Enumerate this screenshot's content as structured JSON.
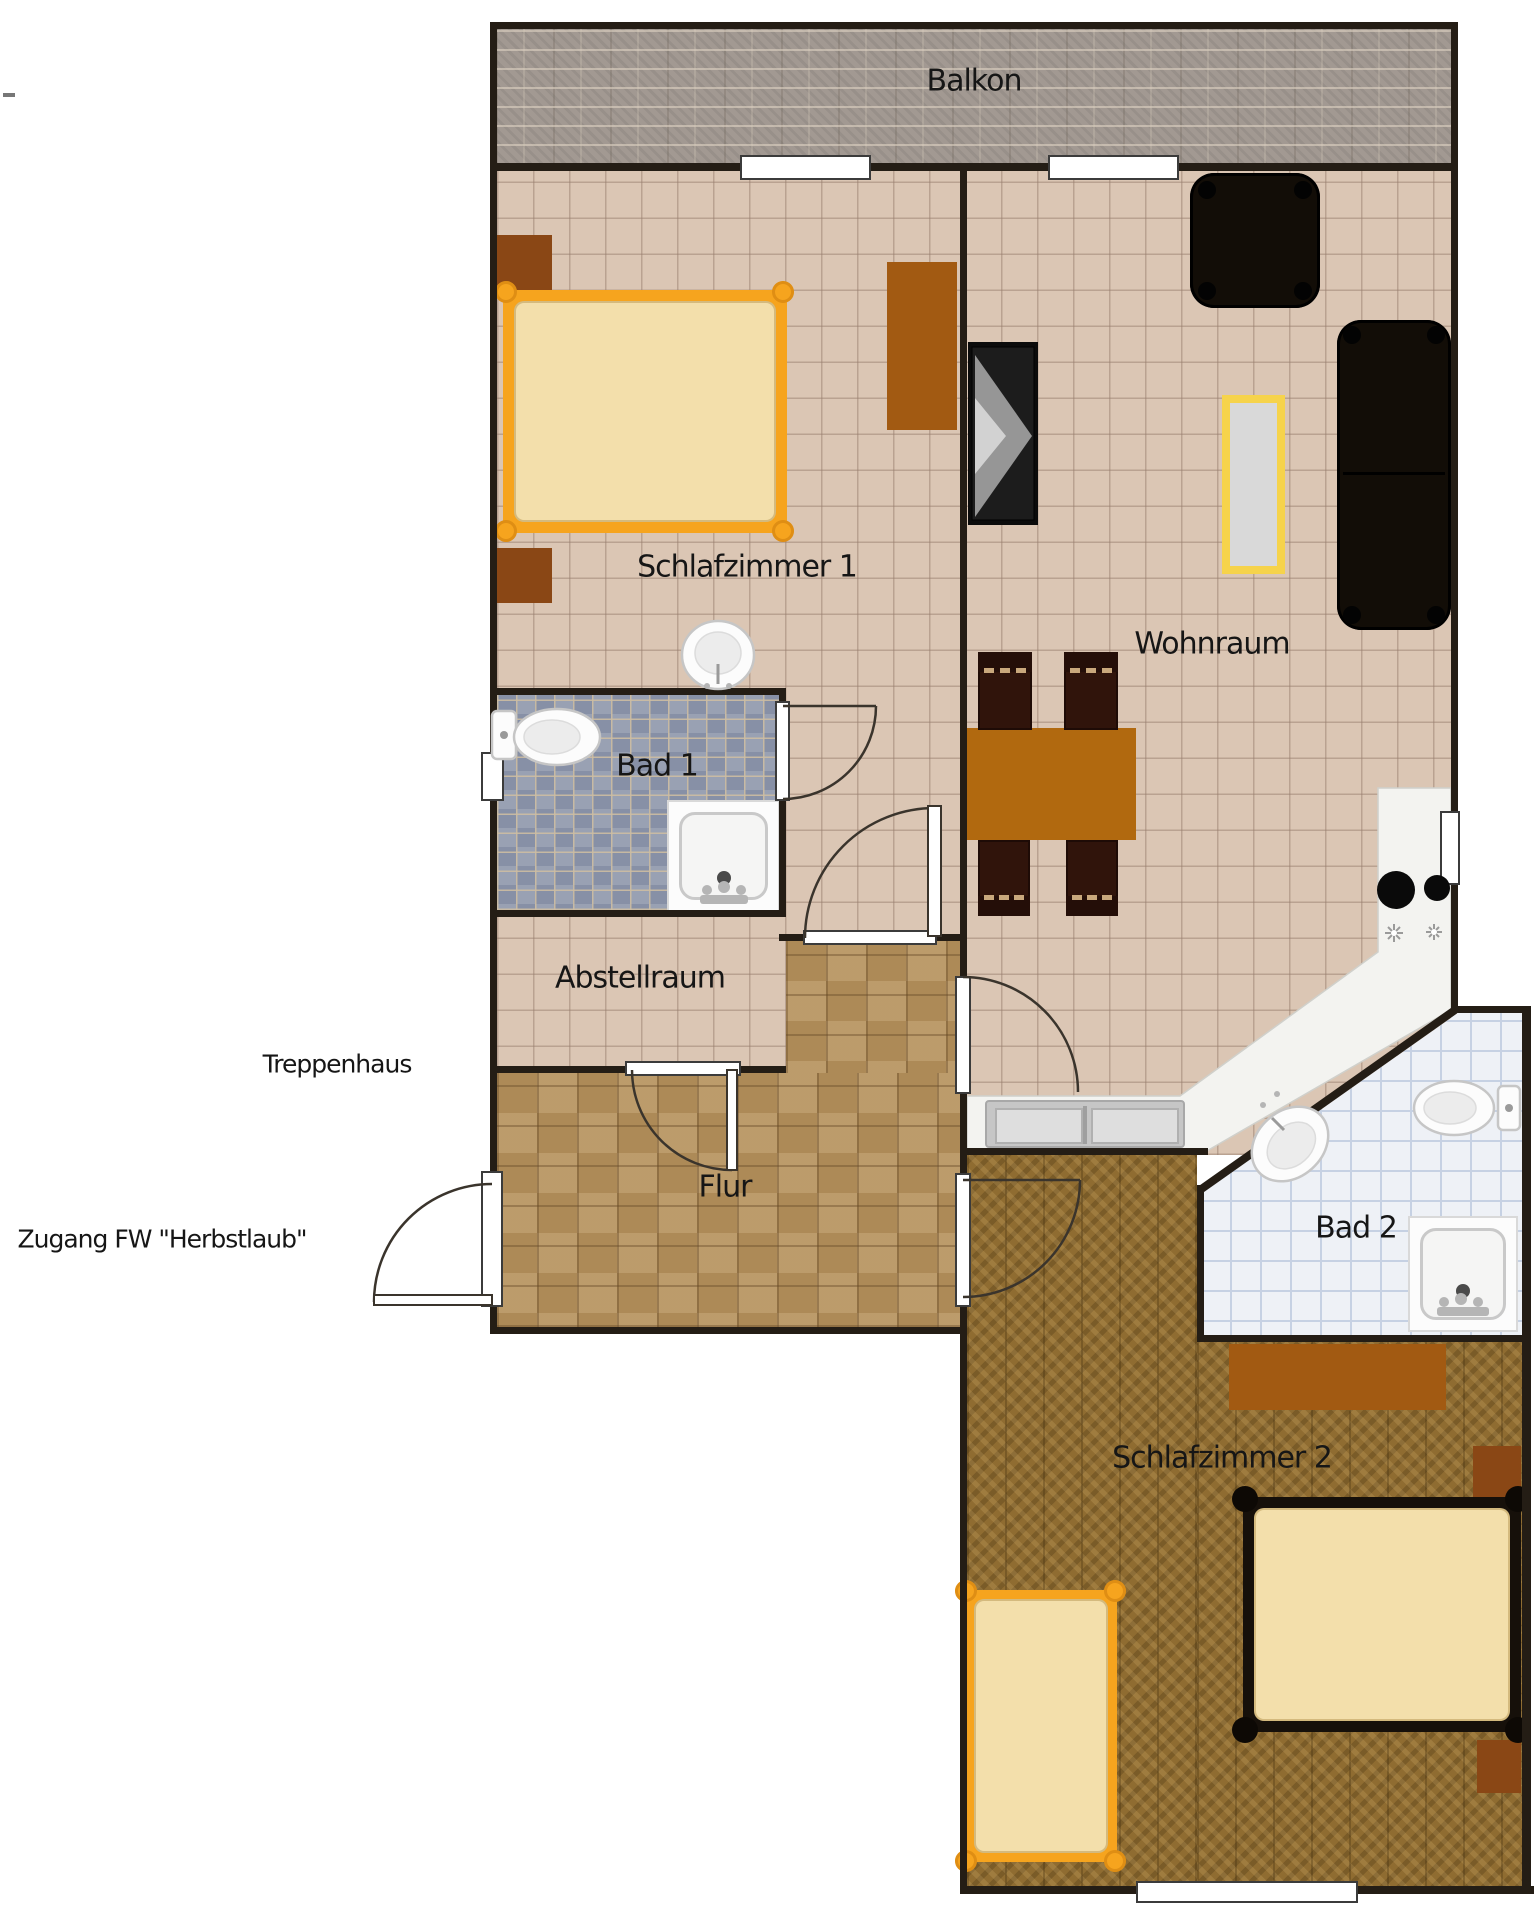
{
  "labels": {
    "balkon": "Balkon",
    "schlafzimmer1": "Schlafzimmer 1",
    "wohnraum": "Wohnraum",
    "bad1": "Bad 1",
    "abstellraum": "Abstellraum",
    "treppenhaus": "Treppenhaus",
    "flur": "Flur",
    "zugang": "Zugang FW \"Herbstlaub\"",
    "bad2": "Bad 2",
    "schlafzimmer2": "Schlafzimmer 2"
  },
  "colors": {
    "wall": "#241d15",
    "door_arc": "#3a342c",
    "opening_border": "#3b3b3b",
    "tile_floor": "#dbc6b4",
    "bad1_tile_a": "#99a1b3",
    "bad1_tile_b": "#8790a6",
    "flur_block": "#ad8a57",
    "parquet": "#8f6c31",
    "bad2_tile": "#eef1f6",
    "bad2_line": "#c6d1e3",
    "balcony_stone": "#a29992",
    "bed_orange": "#f6a41e",
    "bed_dark": "#16100a",
    "mattress": "#f3dfab",
    "wood_dark": "#8a4715",
    "wood_mid": "#a25a12",
    "dining_table": "#b1690f",
    "chair": "#30140b",
    "chair_slat": "#c9a87c",
    "black_furniture": "#120d07",
    "coffee_frame": "#f6d34b",
    "coffee_top": "#d9d9d9",
    "counter": "#f3f3f0",
    "sink_grey": "#c6c6c6",
    "fixture_white": "#fcfcfc",
    "fixture_stroke": "#c6c6c6"
  }
}
